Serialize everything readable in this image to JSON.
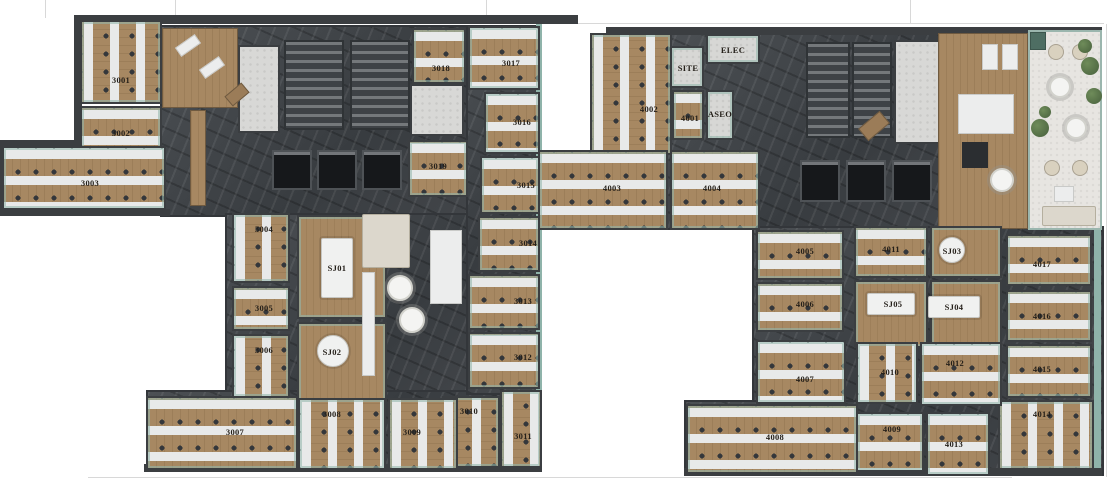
{
  "page": {
    "background": "#ffffff",
    "description": "Two office floor plans rendered top-down, floor 3 left and floor 4 right"
  },
  "palette": {
    "wood": "#a78862",
    "desk": "#e8e9e9",
    "chair": "#34373b",
    "teal": "#8fb3aa",
    "marble": "#45494d",
    "wall": "#3b3e41",
    "elevator": "#16181b",
    "wc": "#d8d8d6",
    "terrace": "#e7e5e1",
    "plant": "#57734a",
    "label": "#241f19",
    "guide": "#d8d8d8"
  },
  "guides": {
    "ticks": [
      [
        45,
        0,
        18
      ],
      [
        175,
        0,
        18
      ],
      [
        486,
        0,
        20
      ],
      [
        910,
        0,
        23
      ]
    ],
    "hlines": [
      [
        578,
        23,
        526
      ],
      [
        88,
        477,
        924
      ]
    ],
    "vlines": [
      [
        1106,
        24,
        453
      ]
    ]
  },
  "floors": [
    {
      "id": "floor-3",
      "corridors": [
        [
          160,
          25,
          380,
          192
        ],
        [
          225,
          213,
          315,
          192
        ],
        [
          146,
          390,
          396,
          82
        ],
        [
          466,
          25,
          76,
          370
        ]
      ],
      "teal": [
        [
          536,
          24,
          6,
          368
        ]
      ],
      "walls": [
        [
          76,
          15,
          502,
          9
        ],
        [
          74,
          15,
          8,
          146
        ],
        [
          0,
          140,
          82,
          7
        ],
        [
          0,
          140,
          6,
          76
        ],
        [
          0,
          209,
          170,
          7
        ],
        [
          144,
          464,
          398,
          8
        ]
      ],
      "cores": [
        {
          "t": "stair",
          "r": [
            284,
            40,
            60,
            90
          ]
        },
        {
          "t": "stair",
          "r": [
            350,
            40,
            60,
            90
          ]
        },
        {
          "t": "wc",
          "r": [
            238,
            45,
            42,
            88
          ]
        },
        {
          "t": "wc",
          "r": [
            410,
            84,
            54,
            52
          ]
        },
        {
          "t": "elev",
          "r": [
            272,
            150,
            40,
            40
          ]
        },
        {
          "t": "elev",
          "r": [
            317,
            150,
            40,
            40
          ]
        },
        {
          "t": "elev",
          "r": [
            362,
            150,
            40,
            40
          ]
        }
      ],
      "bases": [
        {
          "t": "wood",
          "r": [
            162,
            28,
            76,
            80
          ]
        },
        {
          "t": "wood",
          "r": [
            190,
            110,
            16,
            96
          ]
        }
      ],
      "rooms": [
        {
          "label": "3001",
          "r": [
            80,
            20,
            82,
            84
          ],
          "type": "ov",
          "l": [
            121,
            80
          ]
        },
        {
          "label": "3002",
          "r": [
            80,
            106,
            82,
            56
          ],
          "type": "oh",
          "l": [
            121,
            133
          ]
        },
        {
          "label": "3003",
          "r": [
            2,
            146,
            164,
            64
          ],
          "type": "oh",
          "l": [
            90,
            183
          ]
        },
        {
          "label": "3004",
          "r": [
            232,
            213,
            58,
            70
          ],
          "type": "ov",
          "l": [
            264,
            229
          ]
        },
        {
          "label": "3005",
          "r": [
            232,
            286,
            58,
            45
          ],
          "type": "oh",
          "l": [
            264,
            308
          ]
        },
        {
          "label": "3006",
          "r": [
            232,
            334,
            58,
            64
          ],
          "type": "ov",
          "l": [
            264,
            350
          ]
        },
        {
          "label": "SJ01",
          "r": [
            297,
            215,
            90,
            104
          ],
          "type": "mt",
          "l": [
            337,
            268
          ],
          "table": {
            "shape": "rect",
            "r": [
              321,
              238,
              32,
              60
            ]
          }
        },
        {
          "label": "SJ02",
          "r": [
            297,
            322,
            90,
            80
          ],
          "type": "mt",
          "l": [
            332,
            352
          ],
          "table": {
            "shape": "round",
            "c": [
              333,
              351
            ],
            "rad": 16
          }
        },
        {
          "label": "3019",
          "r": [
            408,
            140,
            60,
            57
          ],
          "type": "oh",
          "l": [
            438,
            166
          ]
        },
        {
          "label": "3018",
          "r": [
            412,
            28,
            54,
            56
          ],
          "type": "oh",
          "l": [
            441,
            68
          ]
        },
        {
          "label": "3017",
          "r": [
            468,
            26,
            72,
            64
          ],
          "type": "oh",
          "l": [
            511,
            63
          ]
        },
        {
          "label": "3016",
          "r": [
            484,
            92,
            56,
            62
          ],
          "type": "oh",
          "l": [
            522,
            122
          ]
        },
        {
          "label": "3015",
          "r": [
            480,
            156,
            60,
            58
          ],
          "type": "oh",
          "l": [
            526,
            185
          ]
        },
        {
          "label": "3014",
          "r": [
            478,
            216,
            62,
            56
          ],
          "type": "oh",
          "l": [
            528,
            243
          ]
        },
        {
          "label": "3013",
          "r": [
            468,
            274,
            72,
            56
          ],
          "type": "oh",
          "l": [
            523,
            301
          ]
        },
        {
          "label": "3012",
          "r": [
            468,
            332,
            72,
            57
          ],
          "type": "oh",
          "l": [
            523,
            357
          ]
        },
        {
          "label": "3011",
          "r": [
            500,
            390,
            42,
            78
          ],
          "type": "ov",
          "l": [
            523,
            436
          ]
        },
        {
          "label": "3010",
          "r": [
            442,
            396,
            58,
            72
          ],
          "type": "ov",
          "l": [
            469,
            411
          ]
        },
        {
          "label": "3009",
          "r": [
            388,
            398,
            70,
            72
          ],
          "type": "ov",
          "l": [
            412,
            432
          ]
        },
        {
          "label": "3008",
          "r": [
            298,
            398,
            88,
            72
          ],
          "type": "ov",
          "l": [
            332,
            414
          ]
        },
        {
          "label": "3007",
          "r": [
            146,
            396,
            152,
            74
          ],
          "type": "oh",
          "l": [
            235,
            432
          ]
        }
      ],
      "items": [
        {
          "t": "white",
          "r": [
            176,
            40,
            24,
            11
          ],
          "rot": -35
        },
        {
          "t": "white",
          "r": [
            200,
            62,
            24,
            11
          ],
          "rot": -35
        },
        {
          "t": "woodf",
          "r": [
            226,
            88,
            22,
            13
          ],
          "rot": -40
        },
        {
          "t": "sofa",
          "r": [
            362,
            214,
            48,
            54
          ]
        },
        {
          "t": "white",
          "r": [
            362,
            272,
            13,
            104
          ]
        },
        {
          "t": "white",
          "r": [
            430,
            230,
            32,
            74
          ]
        },
        {
          "t": "rtable",
          "c": [
            400,
            288
          ],
          "rad": 13
        },
        {
          "t": "rtable",
          "c": [
            412,
            320
          ],
          "rad": 13
        }
      ]
    },
    {
      "id": "floor-4",
      "corridors": [
        [
          660,
          30,
          368,
          200
        ],
        [
          752,
          226,
          352,
          186
        ],
        [
          684,
          400,
          420,
          76
        ]
      ],
      "teal": [
        [
          1094,
          228,
          7,
          244
        ]
      ],
      "walls": [
        [
          606,
          27,
          424,
          8
        ],
        [
          1028,
          27,
          74,
          6
        ],
        [
          684,
          468,
          418,
          8
        ]
      ],
      "cores": [
        {
          "t": "stair",
          "r": [
            806,
            42,
            44,
            96
          ]
        },
        {
          "t": "stair",
          "r": [
            852,
            42,
            40,
            96
          ]
        },
        {
          "t": "wc",
          "r": [
            894,
            40,
            46,
            104
          ]
        },
        {
          "t": "elev",
          "r": [
            800,
            160,
            40,
            42
          ]
        },
        {
          "t": "elev",
          "r": [
            846,
            160,
            40,
            42
          ]
        },
        {
          "t": "elev",
          "r": [
            892,
            160,
            40,
            42
          ]
        }
      ],
      "bases": [
        {
          "t": "wood",
          "r": [
            938,
            33,
            90,
            196
          ]
        },
        {
          "t": "terrace",
          "r": [
            1028,
            30,
            74,
            200
          ]
        }
      ],
      "rooms": [
        {
          "label": "4002",
          "r": [
            590,
            33,
            82,
            122
          ],
          "type": "ov",
          "l": [
            649,
            109
          ]
        },
        {
          "label": "SITE",
          "r": [
            670,
            46,
            34,
            42
          ],
          "type": "sv",
          "l": [
            688,
            68
          ]
        },
        {
          "label": "ELEC",
          "r": [
            706,
            34,
            54,
            30
          ],
          "type": "sv",
          "l": [
            733,
            50
          ]
        },
        {
          "label": "4001",
          "r": [
            672,
            90,
            32,
            50
          ],
          "type": "oh",
          "l": [
            690,
            118
          ]
        },
        {
          "label": "ASEO",
          "r": [
            706,
            90,
            28,
            50
          ],
          "type": "sv",
          "l": [
            720,
            114
          ]
        },
        {
          "label": "4003",
          "r": [
            538,
            150,
            130,
            80
          ],
          "type": "oh",
          "l": [
            612,
            188
          ]
        },
        {
          "label": "4004",
          "r": [
            670,
            150,
            90,
            80
          ],
          "type": "oh",
          "l": [
            712,
            188
          ]
        },
        {
          "label": "4005",
          "r": [
            756,
            230,
            88,
            50
          ],
          "type": "oh",
          "l": [
            805,
            251
          ]
        },
        {
          "label": "4006",
          "r": [
            756,
            282,
            88,
            50
          ],
          "type": "oh",
          "l": [
            805,
            304
          ]
        },
        {
          "label": "4011",
          "r": [
            854,
            226,
            74,
            52
          ],
          "type": "oh",
          "l": [
            891,
            249
          ]
        },
        {
          "label": "SJ03",
          "r": [
            930,
            226,
            72,
            52
          ],
          "type": "mt",
          "l": [
            952,
            251
          ],
          "table": {
            "shape": "round",
            "c": [
              952,
              250
            ],
            "rad": 13
          }
        },
        {
          "label": "SJ05",
          "r": [
            854,
            280,
            74,
            68
          ],
          "type": "mt",
          "l": [
            893,
            304
          ],
          "table": {
            "shape": "rect",
            "r": [
              867,
              293,
              48,
              22
            ]
          }
        },
        {
          "label": "SJ04",
          "r": [
            930,
            280,
            72,
            68
          ],
          "type": "mt",
          "l": [
            954,
            307
          ],
          "table": {
            "shape": "rect",
            "r": [
              928,
              296,
              52,
              22
            ]
          }
        },
        {
          "label": "4017",
          "r": [
            1006,
            234,
            86,
            52
          ],
          "type": "oh",
          "l": [
            1042,
            264
          ]
        },
        {
          "label": "4016",
          "r": [
            1006,
            290,
            86,
            52
          ],
          "type": "oh",
          "l": [
            1042,
            316
          ]
        },
        {
          "label": "4015",
          "r": [
            1006,
            344,
            86,
            54
          ],
          "type": "oh",
          "l": [
            1042,
            369
          ]
        },
        {
          "label": "4014",
          "r": [
            998,
            400,
            96,
            70
          ],
          "type": "ov",
          "l": [
            1042,
            414
          ]
        },
        {
          "label": "4007",
          "r": [
            756,
            340,
            90,
            64
          ],
          "type": "oh",
          "l": [
            805,
            379
          ]
        },
        {
          "label": "4010",
          "r": [
            856,
            342,
            62,
            62
          ],
          "type": "ov",
          "l": [
            890,
            372
          ]
        },
        {
          "label": "4012",
          "r": [
            920,
            342,
            82,
            64
          ],
          "type": "oh",
          "l": [
            955,
            363
          ]
        },
        {
          "label": "4008",
          "r": [
            686,
            404,
            172,
            70
          ],
          "type": "oh",
          "l": [
            775,
            437
          ]
        },
        {
          "label": "4009",
          "r": [
            856,
            412,
            68,
            60
          ],
          "type": "oh",
          "l": [
            892,
            429
          ]
        },
        {
          "label": "4013",
          "r": [
            926,
            412,
            64,
            64
          ],
          "type": "oh",
          "l": [
            954,
            444
          ]
        }
      ],
      "items": [
        {
          "t": "white",
          "r": [
            958,
            94,
            56,
            40
          ]
        },
        {
          "t": "white",
          "r": [
            982,
            44,
            16,
            26
          ]
        },
        {
          "t": "white",
          "r": [
            1002,
            44,
            16,
            26
          ]
        },
        {
          "t": "dark",
          "r": [
            962,
            142,
            26,
            26
          ]
        },
        {
          "t": "rtable",
          "c": [
            1002,
            180
          ],
          "rad": 12
        },
        {
          "t": "woodf",
          "r": [
            860,
            118,
            28,
            16
          ],
          "rot": -40
        },
        {
          "t": "planter",
          "r": [
            1030,
            32,
            16,
            18
          ]
        },
        {
          "t": "seat",
          "c": [
            1056,
            52
          ],
          "rad": 8
        },
        {
          "t": "seat",
          "c": [
            1080,
            52
          ],
          "rad": 8
        },
        {
          "t": "seat",
          "c": [
            1052,
            168
          ],
          "rad": 8
        },
        {
          "t": "seat",
          "c": [
            1080,
            168
          ],
          "rad": 8
        },
        {
          "t": "rtable",
          "c": [
            1060,
            87
          ],
          "rad": 11
        },
        {
          "t": "rtable",
          "c": [
            1076,
            128
          ],
          "rad": 11
        },
        {
          "t": "plant",
          "c": [
            1085,
            46
          ],
          "rad": 7
        },
        {
          "t": "plant",
          "c": [
            1090,
            66
          ],
          "rad": 9
        },
        {
          "t": "plant",
          "c": [
            1094,
            96
          ],
          "rad": 8
        },
        {
          "t": "plant",
          "c": [
            1045,
            112
          ],
          "rad": 6
        },
        {
          "t": "plant",
          "c": [
            1040,
            128
          ],
          "rad": 9
        },
        {
          "t": "white",
          "r": [
            1054,
            186,
            20,
            16
          ]
        },
        {
          "t": "sofa",
          "r": [
            1042,
            206,
            54,
            20
          ]
        }
      ]
    }
  ]
}
